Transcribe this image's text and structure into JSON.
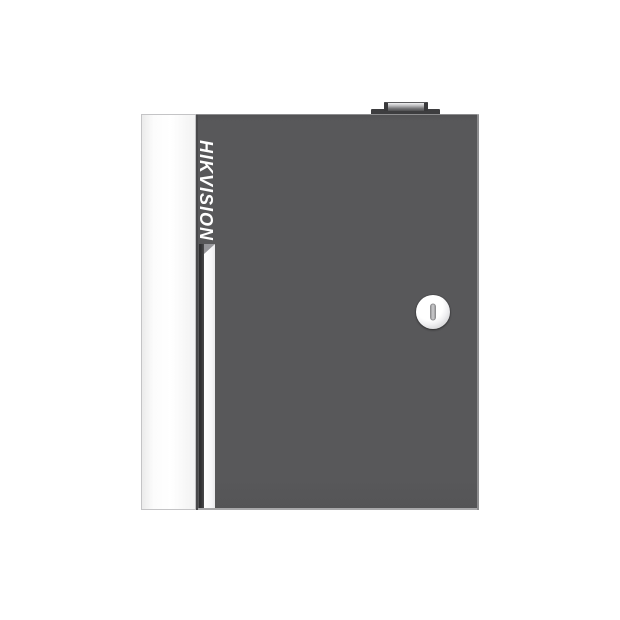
{
  "product": {
    "brand": "HIKVISION",
    "icons": {
      "keyhole_icon": "vertical-key-slot",
      "top_hinge": "rectangular-knob"
    },
    "colors": {
      "bg": "#ffffff",
      "door_gray": "#58585a",
      "door_edge_dark": "#3d3d3f",
      "panel_white": "#fcfcfc",
      "panel_border": "#c4c4c6",
      "stripe_white": "#ffffff",
      "groove_dark": "#323234",
      "lock_ring": "#d9d9db",
      "lock_face": "#ffffff",
      "lock_slot": "#cdcdcf",
      "logo_text": "#ffffff"
    }
  }
}
